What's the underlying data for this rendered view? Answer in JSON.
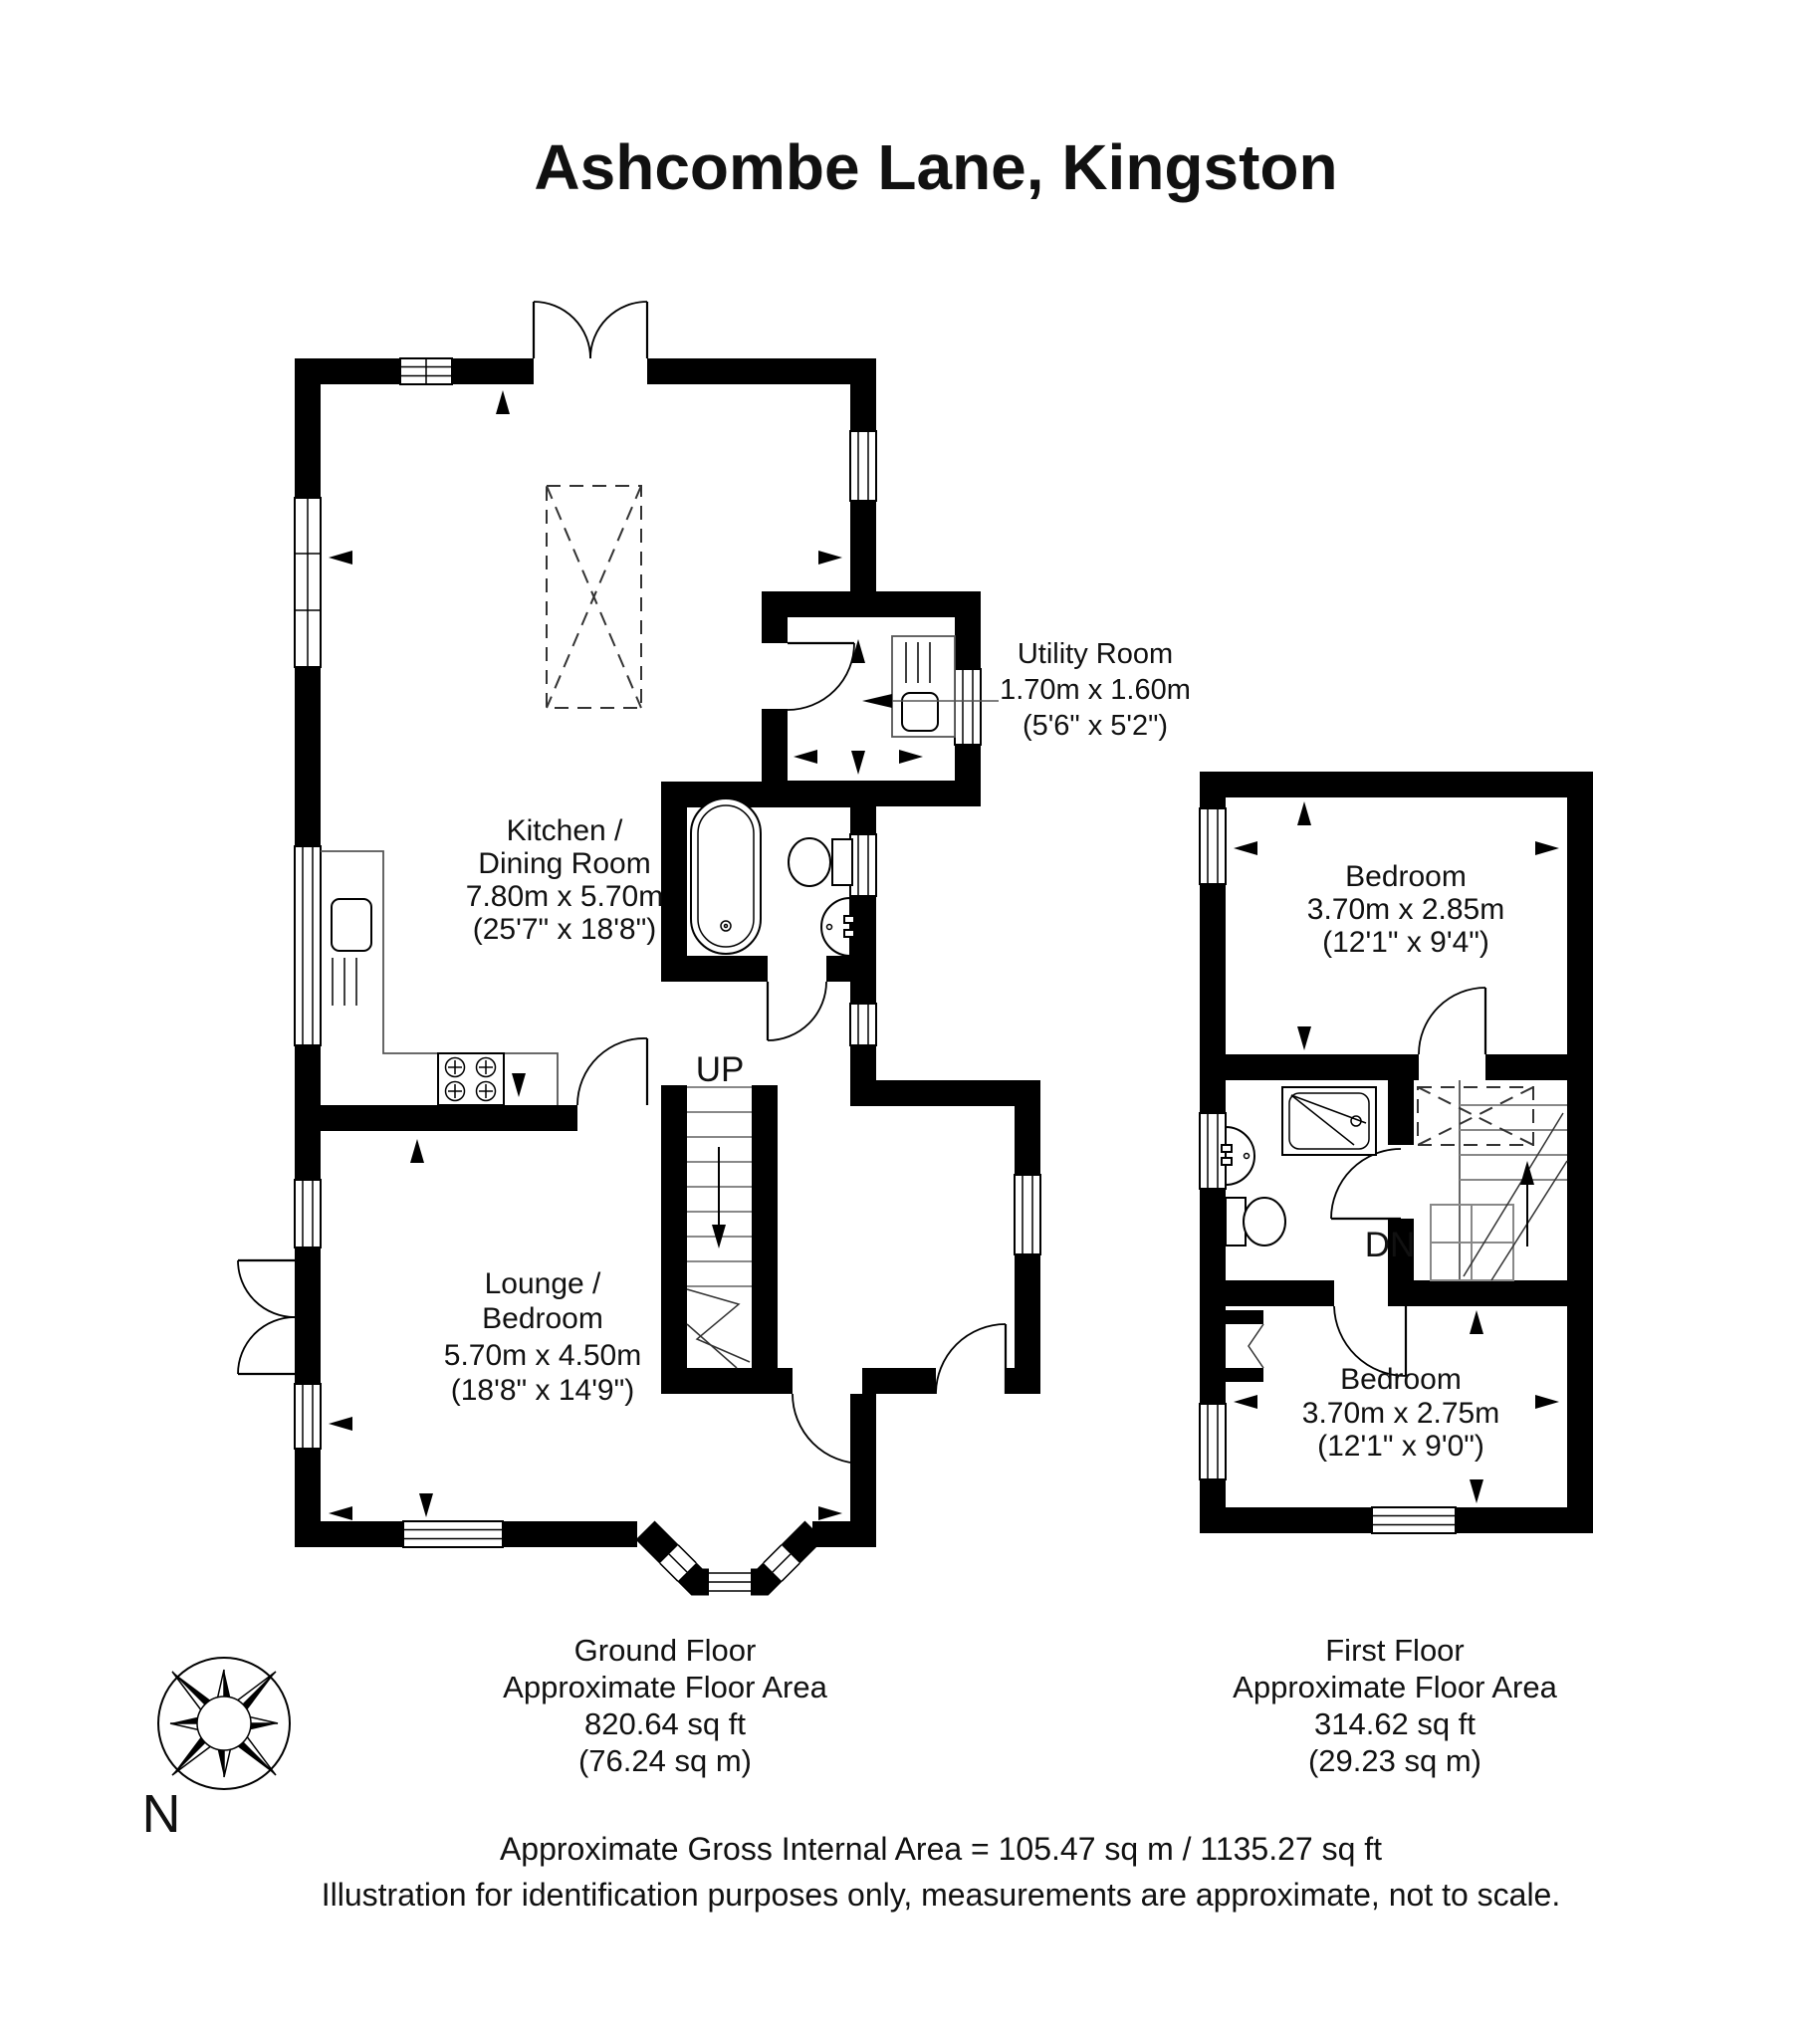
{
  "title": "Ashcombe Lane, Kingston",
  "rooms": {
    "kitchen": {
      "name_line1": "Kitchen /",
      "name_line2": "Dining Room",
      "dims_m": "7.80m x 5.70m",
      "dims_ft": "(25'7\" x 18'8\")"
    },
    "lounge": {
      "name_line1": "Lounge /",
      "name_line2": "Bedroom",
      "dims_m": "5.70m x 4.50m",
      "dims_ft": "(18'8\" x 14'9\")"
    },
    "utility": {
      "name": "Utility Room",
      "dims_m": "1.70m x 1.60m",
      "dims_ft": "(5'6\" x 5'2\")"
    },
    "bedroom1": {
      "name": "Bedroom",
      "dims_m": "3.70m x 2.85m",
      "dims_ft": "(12'1\" x 9'4\")"
    },
    "bedroom2": {
      "name": "Bedroom",
      "dims_m": "3.70m x 2.75m",
      "dims_ft": "(12'1\" x 9'0\")"
    }
  },
  "stairs": {
    "up": "UP",
    "down": "DN"
  },
  "floors": {
    "ground": {
      "name": "Ground Floor",
      "area_label": "Approximate Floor Area",
      "area_ft": "820.64 sq ft",
      "area_m": "(76.24 sq m)"
    },
    "first": {
      "name": "First Floor",
      "area_label": "Approximate Floor Area",
      "area_ft": "314.62 sq ft",
      "area_m": "(29.23 sq m)"
    }
  },
  "footer": {
    "gross_area": "Approximate Gross Internal Area = 105.47 sq m / 1135.27 sq ft",
    "disclaimer": "Illustration for identification purposes only, measurements are approximate, not to scale."
  },
  "compass": {
    "north_label": "N"
  },
  "colors": {
    "wall": "#000000",
    "background": "#ffffff",
    "text": "#111111"
  }
}
